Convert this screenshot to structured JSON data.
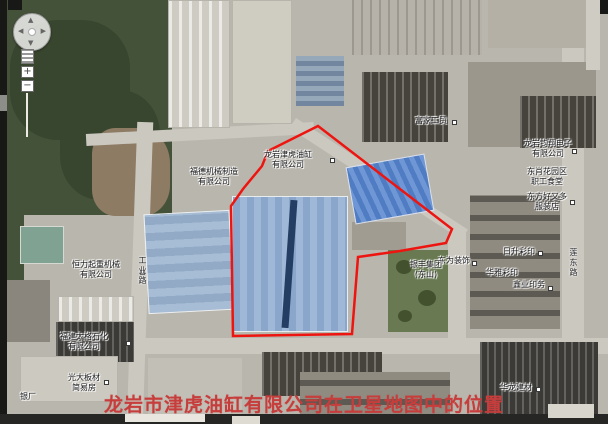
{
  "caption": {
    "text": "龙岩市津虎油缸有限公司在卫星地图中的位置",
    "color": "#c73d3c"
  },
  "map": {
    "type": "satellite",
    "highlight_color": "#ee1510",
    "labels": [
      {
        "text": "福德机械制造\n有限公司"
      },
      {
        "text": "龙岩津虎油缸\n有限公司"
      },
      {
        "text": "富家工贸"
      },
      {
        "text": "龙岩钧翔电子\n有限公司"
      },
      {
        "text": "东肖花园区\n职工食堂"
      },
      {
        "text": "东方好又多\n服装店"
      },
      {
        "text": "日升彩印"
      },
      {
        "text": "华雅彩印"
      },
      {
        "text": "鑫业印务"
      },
      {
        "text": "东为装饰"
      },
      {
        "text": "银丰集团\n(东山)"
      },
      {
        "text": "恒力起重机械\n有限公司"
      },
      {
        "text": "福建太格石化\n有限公司"
      },
      {
        "text": "光大板材\n简易房"
      },
      {
        "text": "银厂"
      },
      {
        "text": "华龙建材"
      }
    ],
    "road_labels": [
      {
        "text": "莲东路"
      },
      {
        "text": "工业路"
      }
    ],
    "controls": {
      "pan_up": "▲",
      "pan_down": "▼",
      "pan_left": "◀",
      "pan_right": "▶",
      "zoom_in": "+",
      "zoom_out": "−"
    }
  }
}
